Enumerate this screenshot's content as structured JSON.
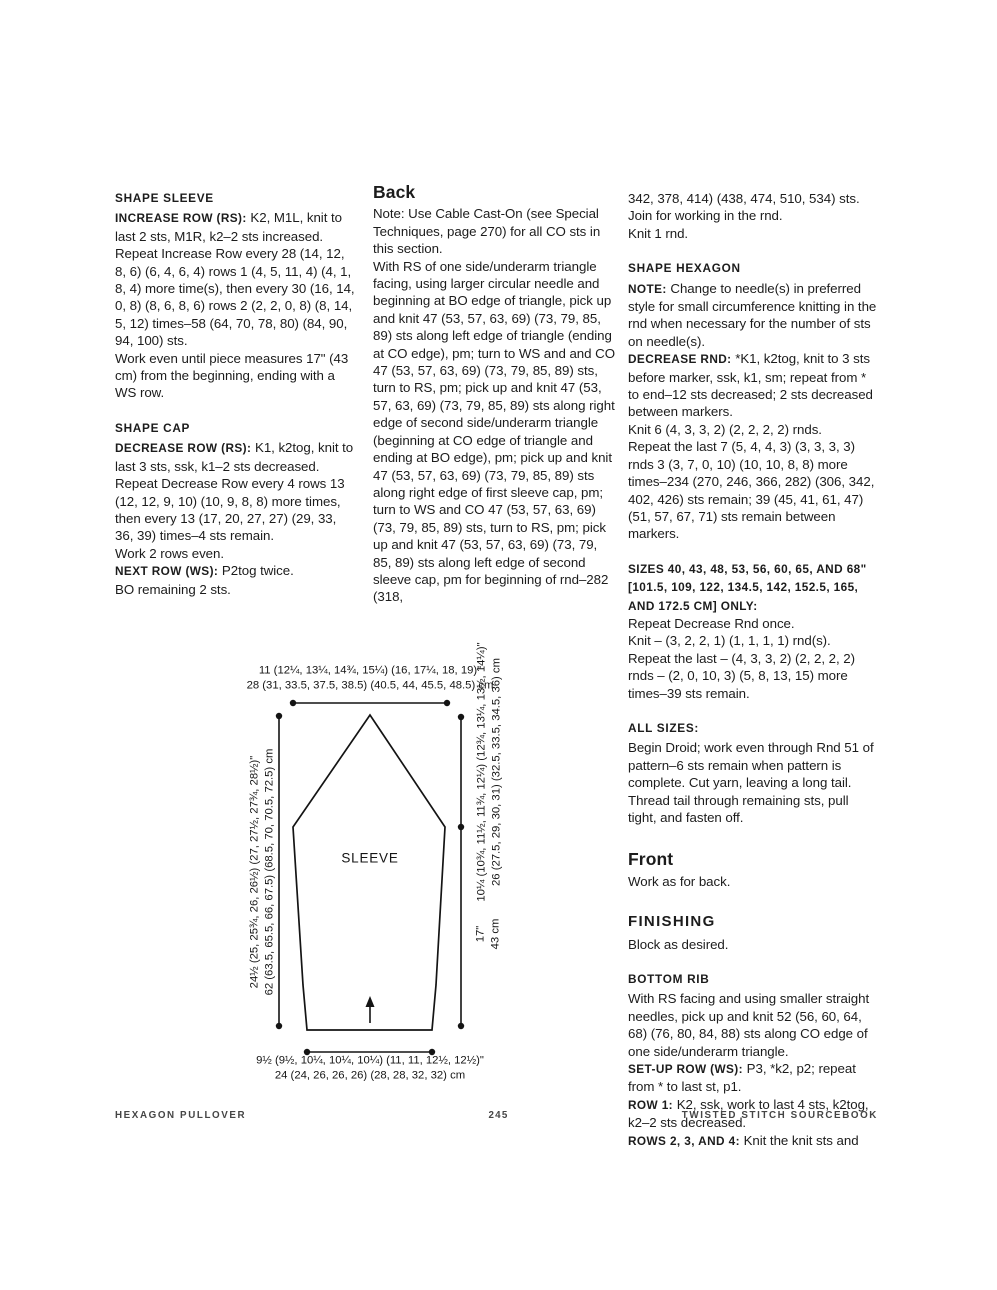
{
  "columns": {
    "left": [
      {
        "type": "h3",
        "text": "SHAPE SLEEVE"
      },
      {
        "type": "p",
        "runs": [
          {
            "b": 1,
            "text": "INCREASE ROW (RS): "
          },
          {
            "text": "K2, M1L, knit to last 2 sts, M1R, k2–2 sts increased."
          }
        ]
      },
      {
        "type": "p",
        "runs": [
          {
            "text": "Repeat Increase Row every 28 (14, 12, 8, 6) (6, 4, 6, 4) rows 1 (4, 5, 11, 4) (4, 1, 8, 4) more time(s), then every 30 (16, 14, 0, 8) (8, 6, 8, 6) rows 2 (2, 2, 0, 8) (8, 14, 5, 12) times–58 (64, 70, 78, 80) (84, 90, 94, 100) sts."
          }
        ]
      },
      {
        "type": "p",
        "runs": [
          {
            "text": "Work even until piece measures 17\" (43 cm) from the beginning, ending with a WS row."
          }
        ]
      },
      {
        "type": "h3",
        "text": "SHAPE CAP"
      },
      {
        "type": "p",
        "runs": [
          {
            "b": 1,
            "text": "DECREASE ROW (RS): "
          },
          {
            "text": "K1, k2tog, knit to last 3 sts, ssk, k1–2 sts decreased."
          }
        ]
      },
      {
        "type": "p",
        "runs": [
          {
            "text": "Repeat Decrease Row every 4 rows 13 (12, 12, 9, 10) (10, 9, 8, 8) more times, then every 13 (17, 20, 27, 27) (29, 33, 36, 39) times–4 sts remain."
          }
        ]
      },
      {
        "type": "p",
        "runs": [
          {
            "text": "Work 2 rows even."
          }
        ]
      },
      {
        "type": "p",
        "runs": [
          {
            "b": 1,
            "text": "NEXT ROW (WS): "
          },
          {
            "text": "P2tog twice."
          }
        ]
      },
      {
        "type": "p",
        "runs": [
          {
            "text": "BO remaining 2 sts."
          }
        ]
      }
    ],
    "middle": [
      {
        "type": "h2",
        "text": "Back"
      },
      {
        "type": "p",
        "runs": [
          {
            "text": "Note: Use Cable Cast-On (see Special Techniques, page 270) for all CO sts in this section."
          }
        ]
      },
      {
        "type": "p",
        "runs": [
          {
            "text": "With RS of one side/underarm triangle facing, using larger circular needle and beginning at BO edge of triangle, pick up and knit 47 (53, 57, 63, 69) (73, 79, 85, 89) sts along left edge of triangle (ending at CO edge), pm; turn to WS and and CO 47 (53, 57, 63, 69) (73, 79, 85, 89) sts, turn to RS, pm; pick up and knit 47 (53, 57, 63, 69) (73, 79, 85, 89) sts along right edge of second side/underarm triangle (beginning at CO edge of triangle and ending at BO edge), pm; pick up and knit 47 (53, 57, 63, 69) (73, 79, 85, 89) sts along right edge of first sleeve cap, pm; turn to WS and CO 47 (53, 57, 63, 69) (73, 79, 85, 89) sts, turn to RS, pm; pick up and knit 47 (53, 57, 63, 69) (73, 79, 85, 89) sts along left edge of second sleeve cap, pm for beginning of rnd–282 (318,"
          }
        ]
      }
    ],
    "right": [
      {
        "type": "p",
        "runs": [
          {
            "text": "342, 378, 414) (438, 474, 510, 534) sts."
          }
        ]
      },
      {
        "type": "p",
        "runs": [
          {
            "text": "Join for working in the rnd."
          }
        ]
      },
      {
        "type": "p",
        "runs": [
          {
            "text": "Knit 1 rnd."
          }
        ]
      },
      {
        "type": "h3",
        "text": "SHAPE HEXAGON"
      },
      {
        "type": "p",
        "runs": [
          {
            "b": 1,
            "text": "NOTE: "
          },
          {
            "text": "Change to needle(s) in preferred style for small circumference knitting in the rnd when necessary for the number of sts on needle(s)."
          }
        ]
      },
      {
        "type": "p",
        "runs": [
          {
            "b": 1,
            "text": "DECREASE RND: "
          },
          {
            "text": "*K1, k2tog, knit to 3 sts before marker, ssk, k1, sm; repeat from * to end–12 sts decreased; 2 sts decreased between markers."
          }
        ]
      },
      {
        "type": "p",
        "runs": [
          {
            "text": "Knit 6 (4, 3, 3, 2) (2, 2, 2, 2) rnds."
          }
        ]
      },
      {
        "type": "p",
        "runs": [
          {
            "text": "Repeat the last 7 (5, 4, 4, 3) (3, 3, 3, 3) rnds 3 (3, 7, 0, 10) (10, 10, 8, 8) more times–234 (270, 246, 366, 282) (306, 342, 402, 426) sts remain; 39 (45, 41, 61, 47) (51, 57, 67, 71) sts remain between markers."
          }
        ]
      },
      {
        "type": "p",
        "gap": true,
        "runs": [
          {
            "b": 1,
            "text": "SIZES 40, 43, 48, 53, 56, 60, 65, AND 68\" [101.5, 109, 122, 134.5, 142, 152.5, 165, AND 172.5 CM] ONLY:"
          }
        ]
      },
      {
        "type": "p",
        "runs": [
          {
            "text": "Repeat Decrease Rnd once."
          }
        ]
      },
      {
        "type": "p",
        "runs": [
          {
            "text": "Knit – (3, 2, 2, 1) (1, 1, 1, 1) rnd(s)."
          }
        ]
      },
      {
        "type": "p",
        "runs": [
          {
            "text": "Repeat the last – (4, 3, 3, 2) (2, 2, 2, 2) rnds – (2, 0, 10, 3) (5, 8, 13, 15) more times–39 sts remain."
          }
        ]
      },
      {
        "type": "h3",
        "text": "ALL SIZES:"
      },
      {
        "type": "p",
        "runs": [
          {
            "text": "Begin Droid; work even through Rnd 51 of pattern–6 sts remain when pattern is complete. Cut yarn, leaving a long tail. Thread tail through remaining sts, pull tight, and fasten off."
          }
        ]
      },
      {
        "type": "h2",
        "text": "Front"
      },
      {
        "type": "p",
        "runs": [
          {
            "text": "Work as for back."
          }
        ]
      },
      {
        "type": "h2c",
        "text": "FINISHING"
      },
      {
        "type": "p",
        "runs": [
          {
            "text": "Block as desired."
          }
        ]
      },
      {
        "type": "h3",
        "text": "BOTTOM RIB"
      },
      {
        "type": "p",
        "runs": [
          {
            "text": "With RS facing and using smaller straight needles, pick up and knit 52 (56, 60, 64, 68) (76, 80, 84, 88) sts along CO edge of one side/underarm triangle."
          }
        ]
      },
      {
        "type": "p",
        "runs": [
          {
            "b": 1,
            "text": "SET-UP ROW (WS): "
          },
          {
            "text": "P3, *k2, p2; repeat from * to last st, p1."
          }
        ]
      },
      {
        "type": "p",
        "runs": [
          {
            "b": 1,
            "text": "ROW 1: "
          },
          {
            "text": "K2, ssk, work to last 4 sts, k2tog, k2–2 sts decreased."
          }
        ]
      },
      {
        "type": "p",
        "runs": [
          {
            "b": 1,
            "text": "ROWS 2, 3, AND 4: "
          },
          {
            "text": "Knit the knit sts and"
          }
        ]
      }
    ]
  },
  "diagram": {
    "label": "SLEEVE",
    "top_width_in": "11 (12¼, 13¼, 14¾, 15¼) (16, 17¼, 18, 19)\"",
    "top_width_cm": "28 (31, 33.5, 37.5, 38.5) (40.5, 44, 45.5, 48.5) cm",
    "length_in": "24½ (25, 25¾, 26, 26½) (27, 27½, 27¾, 28½)\"",
    "length_cm": "62 (63.5, 65.5, 66, 67.5) (68.5, 70, 70.5, 72.5) cm",
    "cap_in": "10¼ (10¾, 11½, 11¾, 12¼) (12¾, 13¼, 13½, 14¼)\"",
    "cap_cm": "26 (27.5, 29, 30, 31) (32.5, 33.5, 34.5, 36) cm",
    "underarm_in": "17\"",
    "underarm_cm": "43 cm",
    "cuff_in": "9½ (9½, 10¼, 10¼, 10¼) (11, 11, 12½, 12½)\"",
    "cuff_cm": "24 (24, 26, 26, 26) (28, 28, 32, 32) cm"
  },
  "footer": {
    "left": "HEXAGON PULLOVER",
    "page_number": "245",
    "right": "TWISTED STITCH SOURCEBOOK"
  }
}
